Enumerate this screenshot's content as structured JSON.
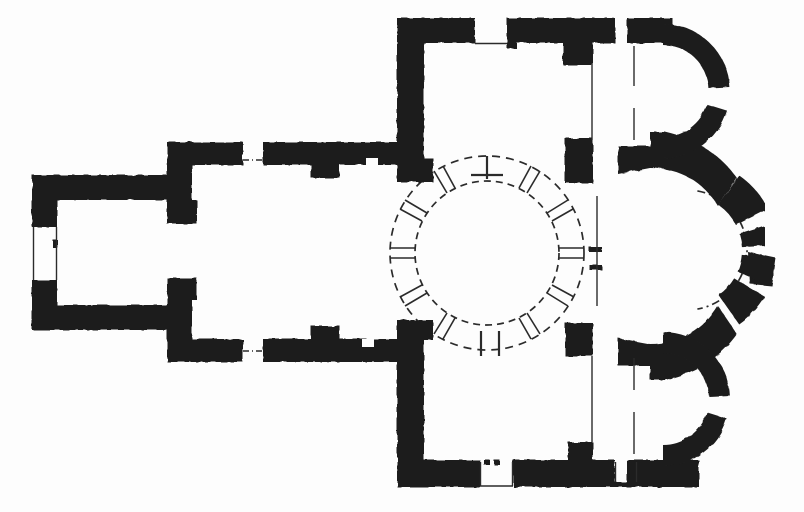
{
  "document": {
    "kind": "scanned architectural floor plan drawing (no text labels visible)",
    "colors": {
      "paper": "#fdfdfd",
      "ink": "#1e1e1e",
      "line": "#2b2b2b"
    },
    "features": [
      "western-room-narthex",
      "western-bay-naos",
      "north-cross-arm",
      "south-cross-arm",
      "central-dome-ring",
      "main-eastern-apse",
      "northeast-chapel-apse",
      "southeast-chapel-apse",
      "wall-window-openings",
      "crossing-piers"
    ]
  }
}
